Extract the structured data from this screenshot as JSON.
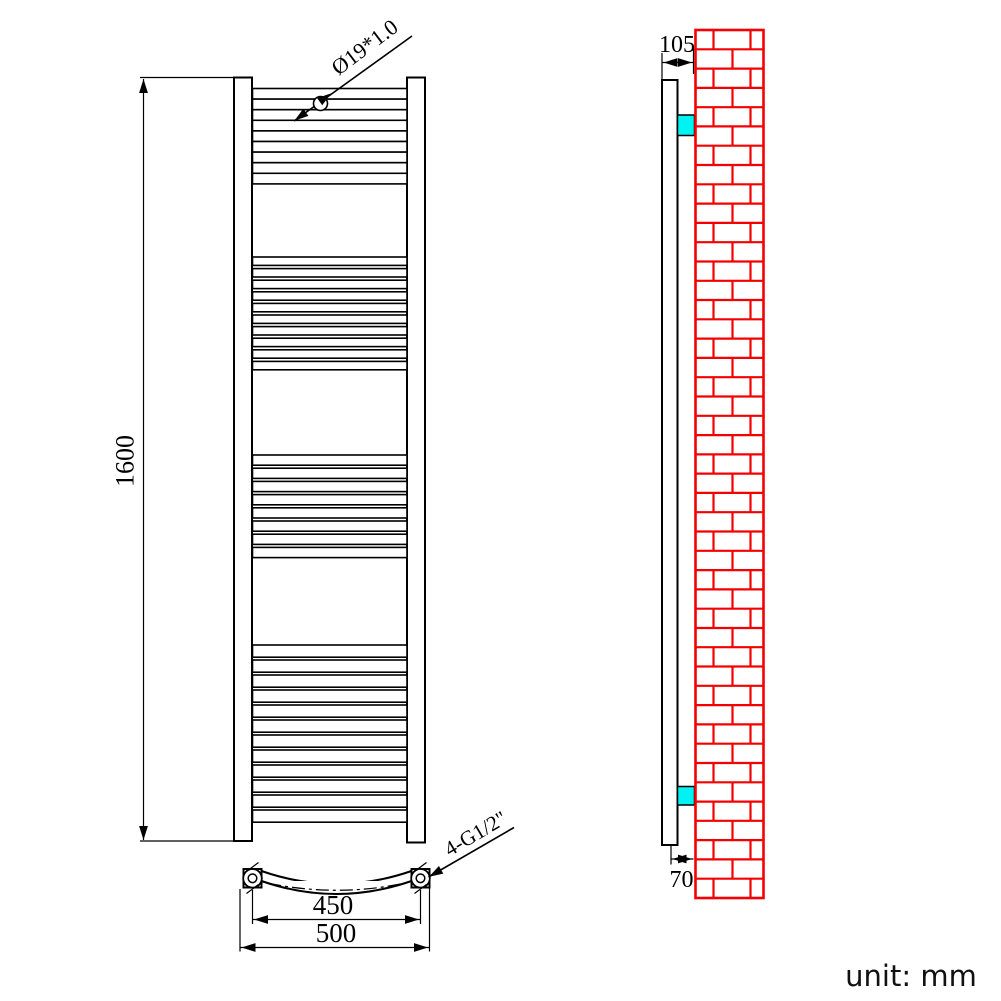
{
  "labels": {
    "height": "1600",
    "tube_spec": "Ø19*1.0",
    "inner_width": "450",
    "outer_width": "500",
    "fitting_spec": "4-G1/2\"",
    "wall_offset_top": "105",
    "wall_offset_bottom": "70",
    "unit": "unit: mm"
  },
  "colors": {
    "line": "#000000",
    "wall": "#f50000",
    "bracket": "#00f2f2",
    "background": "#ffffff"
  },
  "drawing": {
    "front_rungs": {
      "x": 252.5,
      "width": 154.5,
      "groups": [
        {
          "y": 88.5,
          "count": 9,
          "tube": 10.6,
          "gap": 0
        },
        {
          "y": 257,
          "count": 10,
          "tube": 8.4,
          "gap": 3.2
        },
        {
          "y": 455,
          "count": 8,
          "tube": 10.2,
          "gap": 3.0
        },
        {
          "y": 645,
          "count": 12,
          "tube": 12.2,
          "gap": 2.8
        }
      ]
    },
    "wall": {
      "x0": 695.5,
      "x1": 763.5,
      "y0": 30,
      "y1": 898,
      "rows": 45,
      "joints_even": [
        713.5,
        750.5
      ],
      "joints_odd": [
        732.5
      ]
    }
  }
}
